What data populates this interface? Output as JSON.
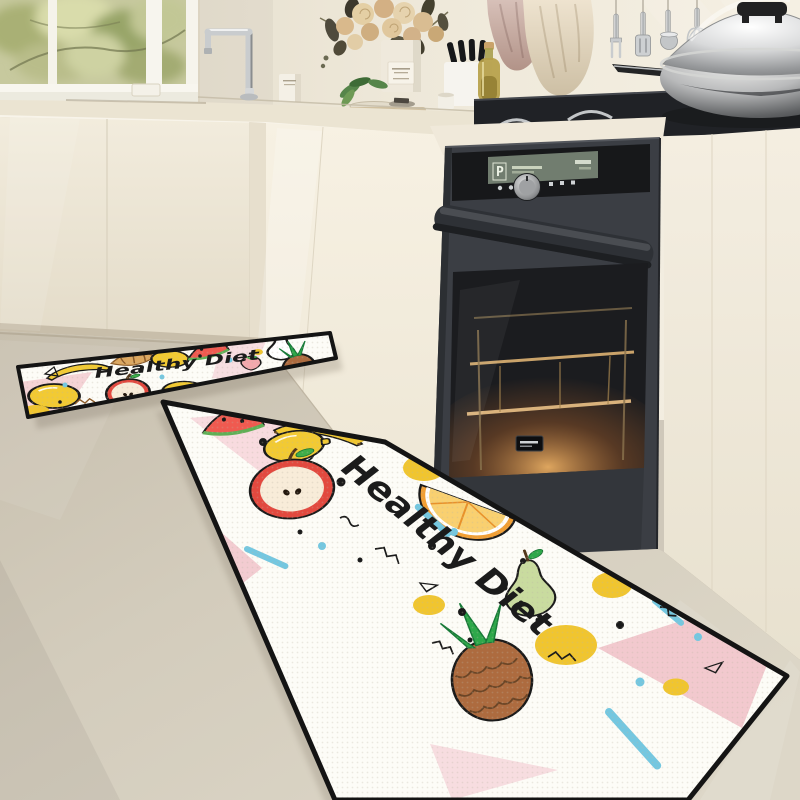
{
  "mats": {
    "runner_text": "Healthy Diet",
    "small_mat_text": "Healthy Diet"
  },
  "oven": {
    "display_mode": "P"
  },
  "palette": {
    "wall": "#eee8d9",
    "cabinet": "#f1ebdd",
    "counter": "#ebe4d2",
    "floor": "#d3ccbc",
    "oven_body": "#3b3e44",
    "mat_background": "#fdfcf7",
    "mat_pink": "#f3ccd1",
    "mat_yellow": "#f0c52f",
    "mat_blue": "#74c7e0",
    "mat_red": "#e2493f",
    "mat_green": "#c9db9f",
    "mat_brown": "#ad6b3f",
    "mat_outline": "#1a1a1a"
  }
}
